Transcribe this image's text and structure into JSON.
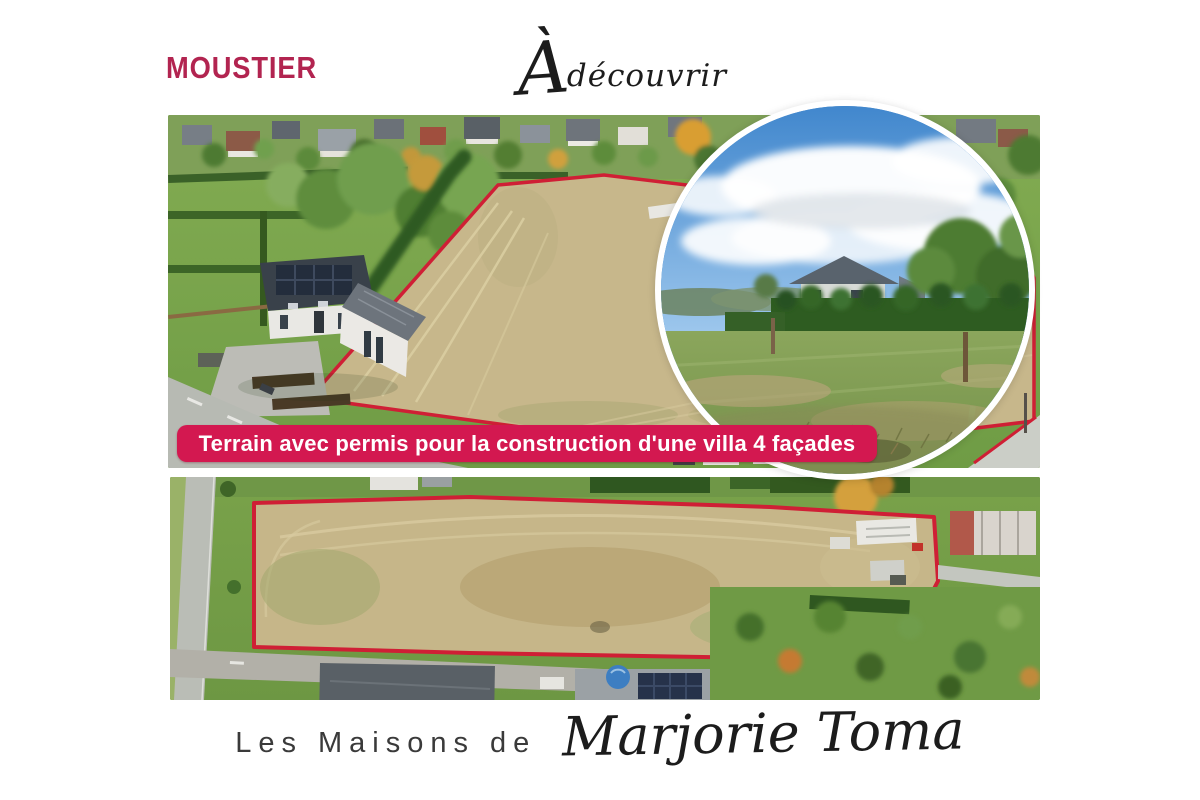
{
  "header": {
    "location": "MOUSTIER",
    "tagline_initial": "À",
    "tagline_rest": "découvrir"
  },
  "banner": {
    "text": "Terrain avec permis pour la construction d'une villa 4 façades"
  },
  "footer": {
    "prefix": "Les Maisons de",
    "signature": "Marjorie Toma"
  },
  "photos": {
    "top_aerial": {
      "alt": "Vue aérienne du terrain à bâtir délimité en rouge, avec maison voisine"
    },
    "inset_circle": {
      "alt": "Vue du terrain depuis le sol : prairie, haie et ciel bleu"
    },
    "bottom_aerial": {
      "alt": "Vue aérienne verticale de la parcelle délimitée en rouge"
    }
  },
  "colors": {
    "accent_pink": "#d31850",
    "brand_magenta": "#b22450",
    "outline_red": "#cf1f35",
    "ink": "#1c1c1c",
    "text_gray": "#3a3a3a",
    "page_bg": "#ffffff"
  }
}
